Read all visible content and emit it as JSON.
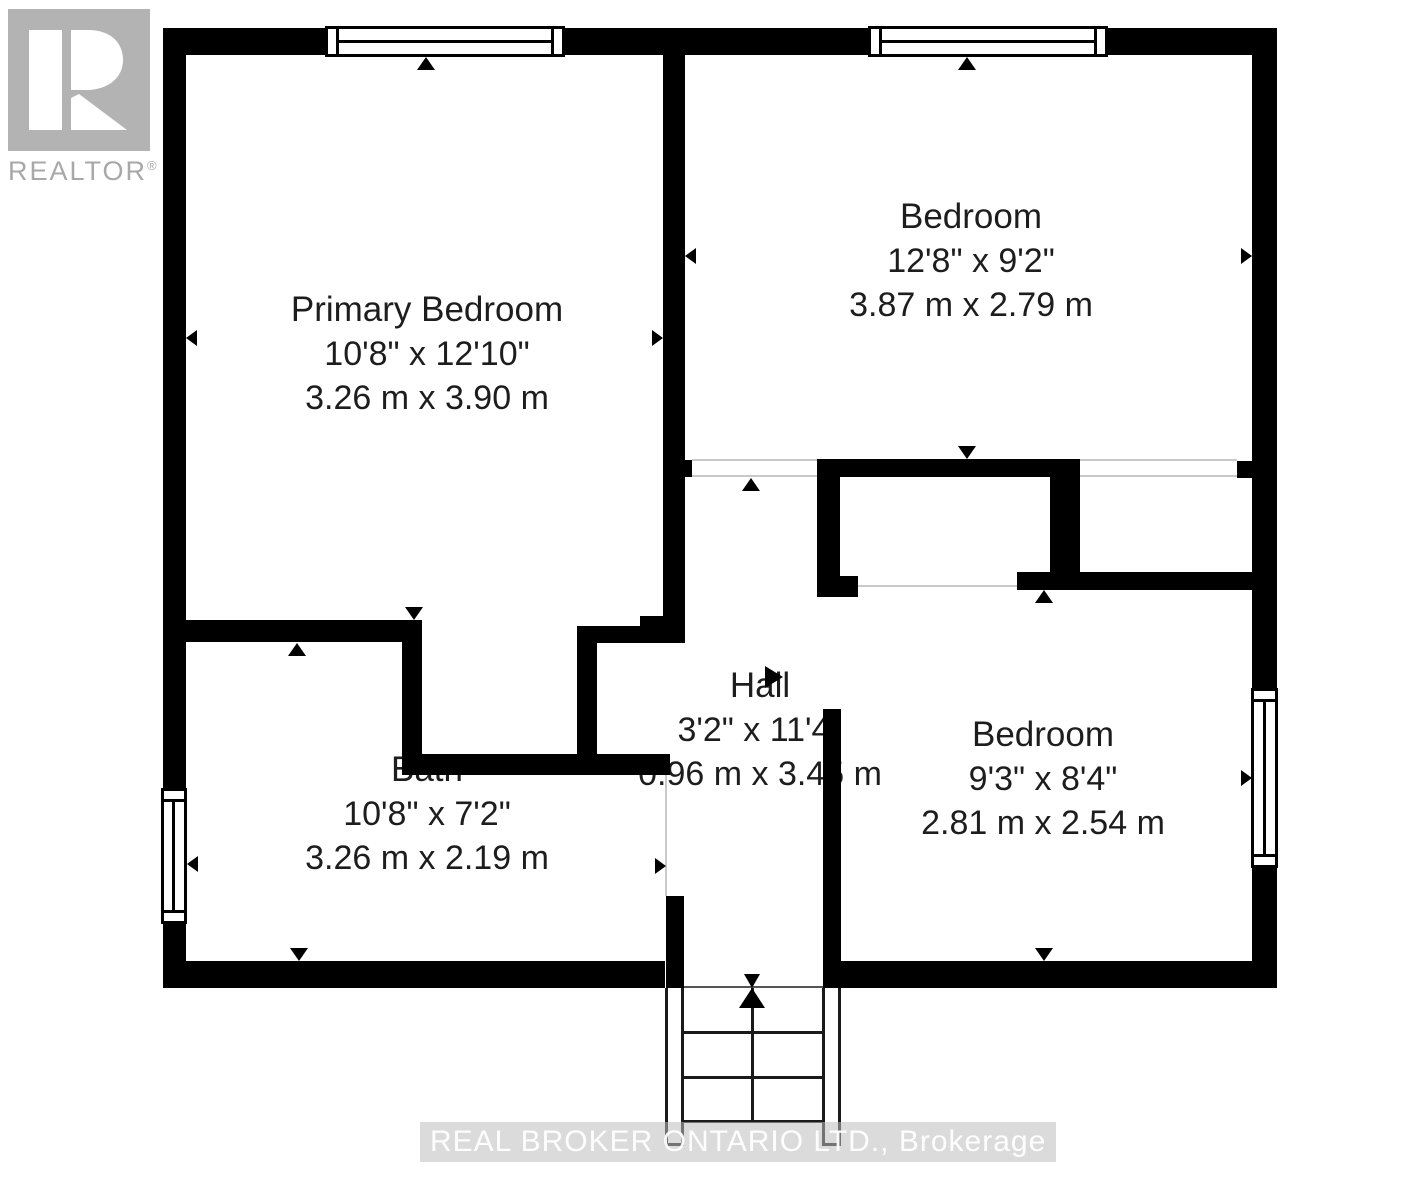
{
  "logo": {
    "text": "REALTOR",
    "reg": "®"
  },
  "rooms": [
    {
      "name": "Primary Bedroom",
      "imperial": "10'8\" x 12'10\"",
      "metric": "3.26 m x 3.90 m"
    },
    {
      "name": "Bedroom",
      "imperial": "12'8\" x 9'2\"",
      "metric": "3.87 m x 2.79 m"
    },
    {
      "name": "Bath",
      "imperial": "10'8\" x 7'2\"",
      "metric": "3.26 m x 2.19 m"
    },
    {
      "name": "Hall",
      "imperial": "3'2\" x 11'4\"",
      "metric": "0.96 m x 3.45 m"
    },
    {
      "name": "Bedroom",
      "imperial": "9'3\" x 8'4\"",
      "metric": "2.81 m x 2.54 m"
    }
  ],
  "watermark": {
    "text": "REAL BROKER ONTARIO LTD., Brokerage"
  },
  "colors": {
    "wall": "#000000",
    "opening_line": "#c9c9c9",
    "stair": "#1a1a1a",
    "text": "#1d1d1d",
    "logo": "#b3b3b3",
    "logo_text": "#a8a8a8"
  }
}
